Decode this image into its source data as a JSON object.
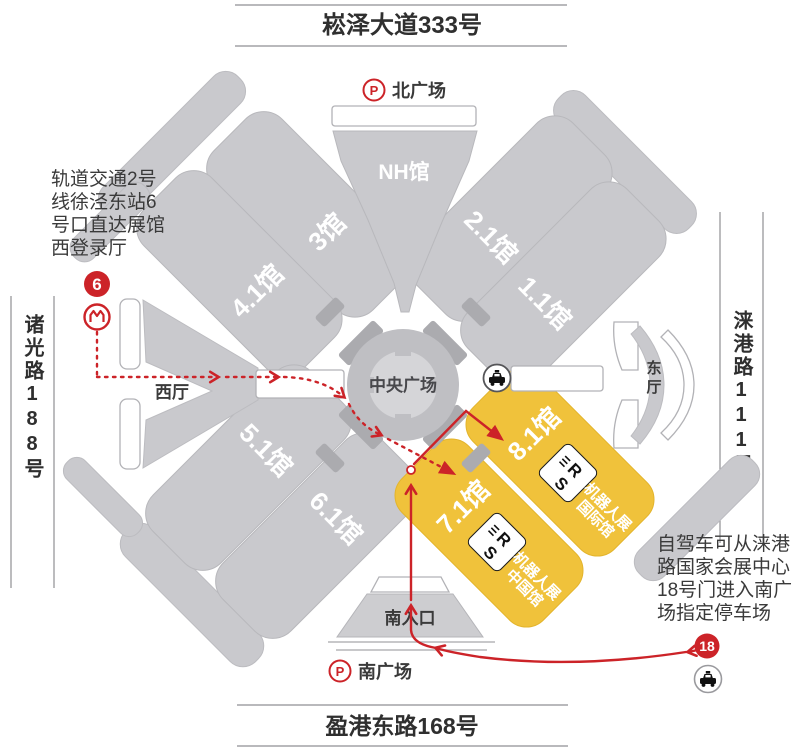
{
  "map": {
    "title_north": "崧泽大道333号",
    "title_south": "盈港东路168号",
    "road_west": "诸光路188号",
    "road_east": "涞港路111号",
    "parking": "P",
    "squares": {
      "north": "北广场",
      "south": "南广场"
    },
    "halls": {
      "nh": "NH馆",
      "h21": "2.1馆",
      "h11": "1.1馆",
      "h3": "3馆",
      "h41": "4.1馆",
      "h51": "5.1馆",
      "h61": "6.1馆",
      "h71": "7.1馆",
      "h81": "8.1馆"
    },
    "places": {
      "central": "中央广场",
      "west_hall": "西厅",
      "east_hall": "东厅",
      "south_entrance": "南入口"
    },
    "badges": {
      "metro_exit": "6",
      "gate": "18"
    },
    "notes": {
      "metro": [
        "轨道交通2号",
        "线徐泾东站6",
        "号口直达展馆",
        "西登录厅"
      ],
      "drive": [
        "自驾车可从涞港",
        "路国家会展中心",
        "18号门进入南广",
        "场指定停车场"
      ]
    },
    "expo": {
      "rs": "RS",
      "show": "机器人展",
      "intl": "国际馆",
      "china": "中国馆"
    },
    "colors": {
      "highlight": "#F0C23B",
      "route": "#CC2328",
      "hall_gray": "#C9C9CD"
    }
  }
}
